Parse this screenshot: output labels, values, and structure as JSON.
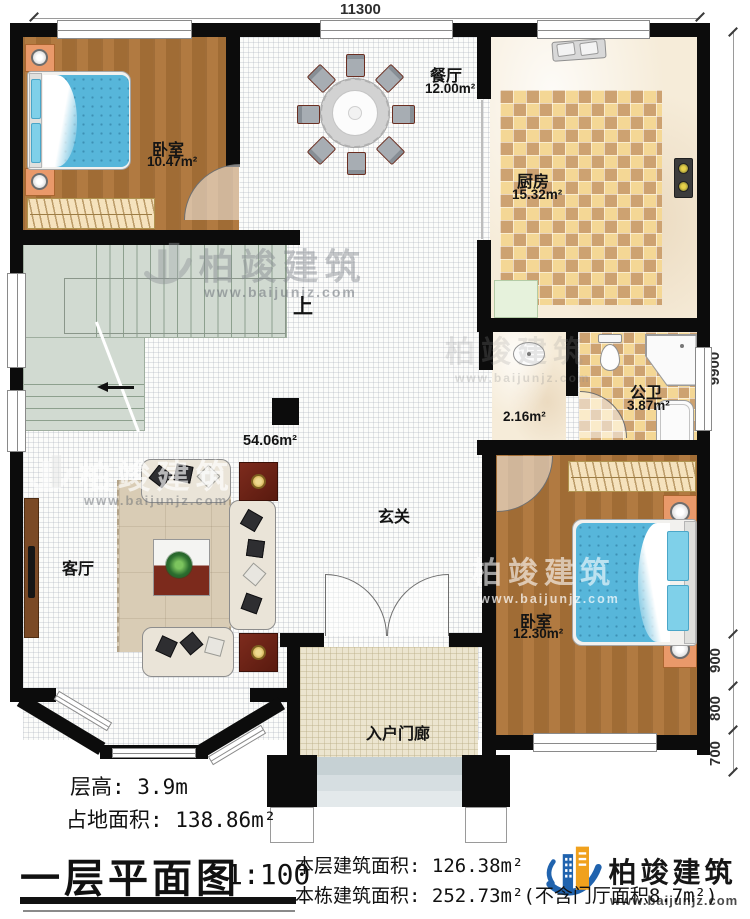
{
  "plan": {
    "dimensions": {
      "width_top": "11300",
      "right": [
        "9900",
        "900",
        "800",
        "700"
      ]
    },
    "rooms": {
      "bedroom1": {
        "name": "卧室",
        "area": "10.47m²"
      },
      "dining": {
        "name": "餐厅",
        "area": "12.00m²"
      },
      "kitchen": {
        "name": "厨房",
        "area": "15.32m²"
      },
      "bathroom": {
        "name": "公卫",
        "area": "3.87m²"
      },
      "hallway": {
        "area": "2.16m²"
      },
      "foyer": {
        "name": "玄关",
        "area": "54.06m²"
      },
      "living": {
        "name": "客厅"
      },
      "bedroom2": {
        "name": "卧室",
        "area": "12.30m²"
      },
      "porch": {
        "name": "入户门廊"
      },
      "stairs": {
        "label": "上"
      }
    }
  },
  "brand": {
    "name": "柏竣建筑",
    "url": "www.baijunjz.com"
  },
  "footer": {
    "floor_height": "层高: 3.9m",
    "footprint": "占地面积: 138.86m²",
    "title": "一层平面图",
    "scale": "1:100",
    "floor_area": "本层建筑面积: 126.38m²",
    "building_area": "本栋建筑面积: 252.73m²(不含门厅面积8.7m²)"
  },
  "colors": {
    "wall": "#0c0c0c",
    "wood_floor": "#a8733a",
    "bed_blue": "#57b6da",
    "logo_blue": "#2063ae",
    "logo_orange": "#f0a11d"
  }
}
